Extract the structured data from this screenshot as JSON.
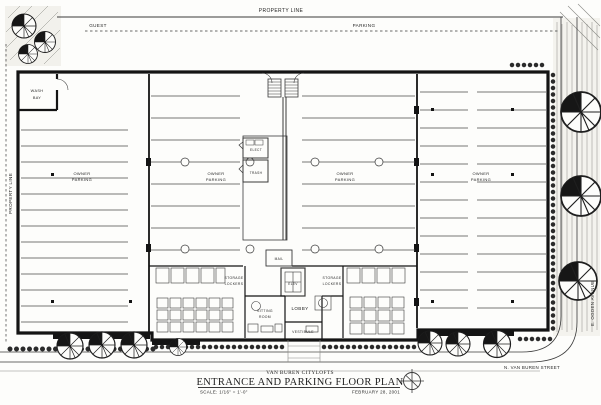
{
  "title_block": {
    "project": "VAN BUREN CITYLOFTS",
    "sheet_title": "ENTRANCE AND PARKING FLOOR PLAN",
    "scale": "SCALE: 1/16\" = 1'-0\"",
    "date": "FEBRUARY 28, 2001",
    "north_arrow_icon": "north-arrow"
  },
  "site": {
    "property_line_top": "PROPERTY LINE",
    "property_line_left": "PROPERTY LINE",
    "guest_label": "GUEST",
    "parking_label": "PARKING",
    "street_bottom": "N. VAN BUREN STREET",
    "street_right": "E. OGDEN AVENUE"
  },
  "rooms": {
    "wash_bay": [
      "WASH",
      "BAY"
    ],
    "owner_parking": [
      "OWNER",
      "PARKING"
    ],
    "elect": "ELECT",
    "trash": "TRASH",
    "mail": "MAIL",
    "elev": "ELEV",
    "storage_lockers": [
      "STORAGE",
      "LOCKERS"
    ],
    "sitting_room": [
      "SITTING",
      "ROOM"
    ],
    "lobby": "LOBBY",
    "vestibule": "VESTIBULE"
  },
  "colors": {
    "ink": "#1a1a1a",
    "paper": "#fdfdfb"
  }
}
